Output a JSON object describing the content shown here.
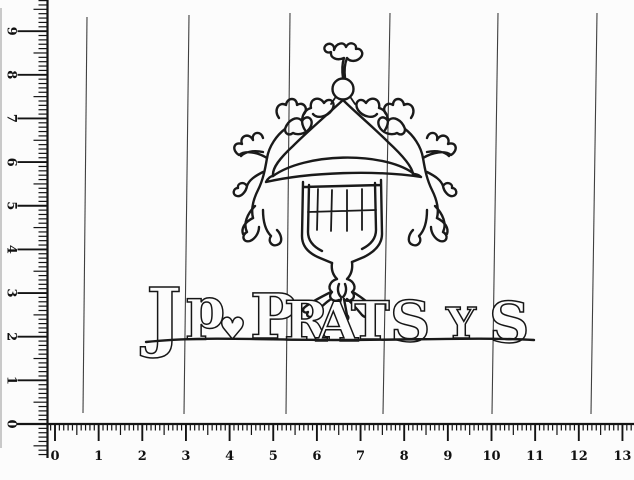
{
  "meta": {
    "description": "Scanned tracing of a paper watermark with measurement rulers",
    "background_color": "#fcfcfc",
    "ink_color": "#1a1a1a",
    "chain_line_color": "#3f3f3f"
  },
  "rulers": {
    "horizontal": {
      "labels": [
        "0",
        "1",
        "2",
        "3",
        "4",
        "5",
        "6",
        "7",
        "8",
        "9",
        "10",
        "11",
        "12",
        "13"
      ]
    },
    "vertical": {
      "labels": [
        "0",
        "1",
        "2",
        "3",
        "4",
        "5",
        "6",
        "7",
        "8",
        "9"
      ]
    }
  },
  "chain_lines": [
    {
      "x_top": 87,
      "y_top": 17,
      "x_bottom": 83,
      "y_bottom": 413
    },
    {
      "x_top": 189,
      "y_top": 15,
      "x_bottom": 184,
      "y_bottom": 414
    },
    {
      "x_top": 290,
      "y_top": 13,
      "x_bottom": 286,
      "y_bottom": 414
    },
    {
      "x_top": 390,
      "y_top": 13,
      "x_bottom": 383,
      "y_bottom": 414
    },
    {
      "x_top": 498,
      "y_top": 13,
      "x_bottom": 492,
      "y_bottom": 414
    },
    {
      "x_top": 597,
      "y_top": 13,
      "x_bottom": 591,
      "y_bottom": 414
    }
  ],
  "watermark": {
    "subject": "heraldic emblem: onion dome with orb and finial over striped shield with knot and ribbon tails, flanked by dragon supporters",
    "text": "Jp ♥ PRATS Y S",
    "letters": [
      {
        "char": "J",
        "x": 146,
        "y": 342,
        "size": 76
      },
      {
        "char": "p",
        "x": 186,
        "y": 328,
        "size": 56
      },
      {
        "char": "♥",
        "x": 219,
        "y": 339,
        "size": 30
      },
      {
        "char": "P",
        "x": 250,
        "y": 338,
        "size": 62
      },
      {
        "char": "R",
        "x": 284,
        "y": 340,
        "size": 54
      },
      {
        "char": "A",
        "x": 316,
        "y": 341,
        "size": 54
      },
      {
        "char": "T",
        "x": 351,
        "y": 339,
        "size": 52
      },
      {
        "char": "S",
        "x": 390,
        "y": 341,
        "size": 56
      },
      {
        "char": "Y",
        "x": 446,
        "y": 338,
        "size": 42
      },
      {
        "char": "S",
        "x": 489,
        "y": 342,
        "size": 56
      }
    ]
  }
}
